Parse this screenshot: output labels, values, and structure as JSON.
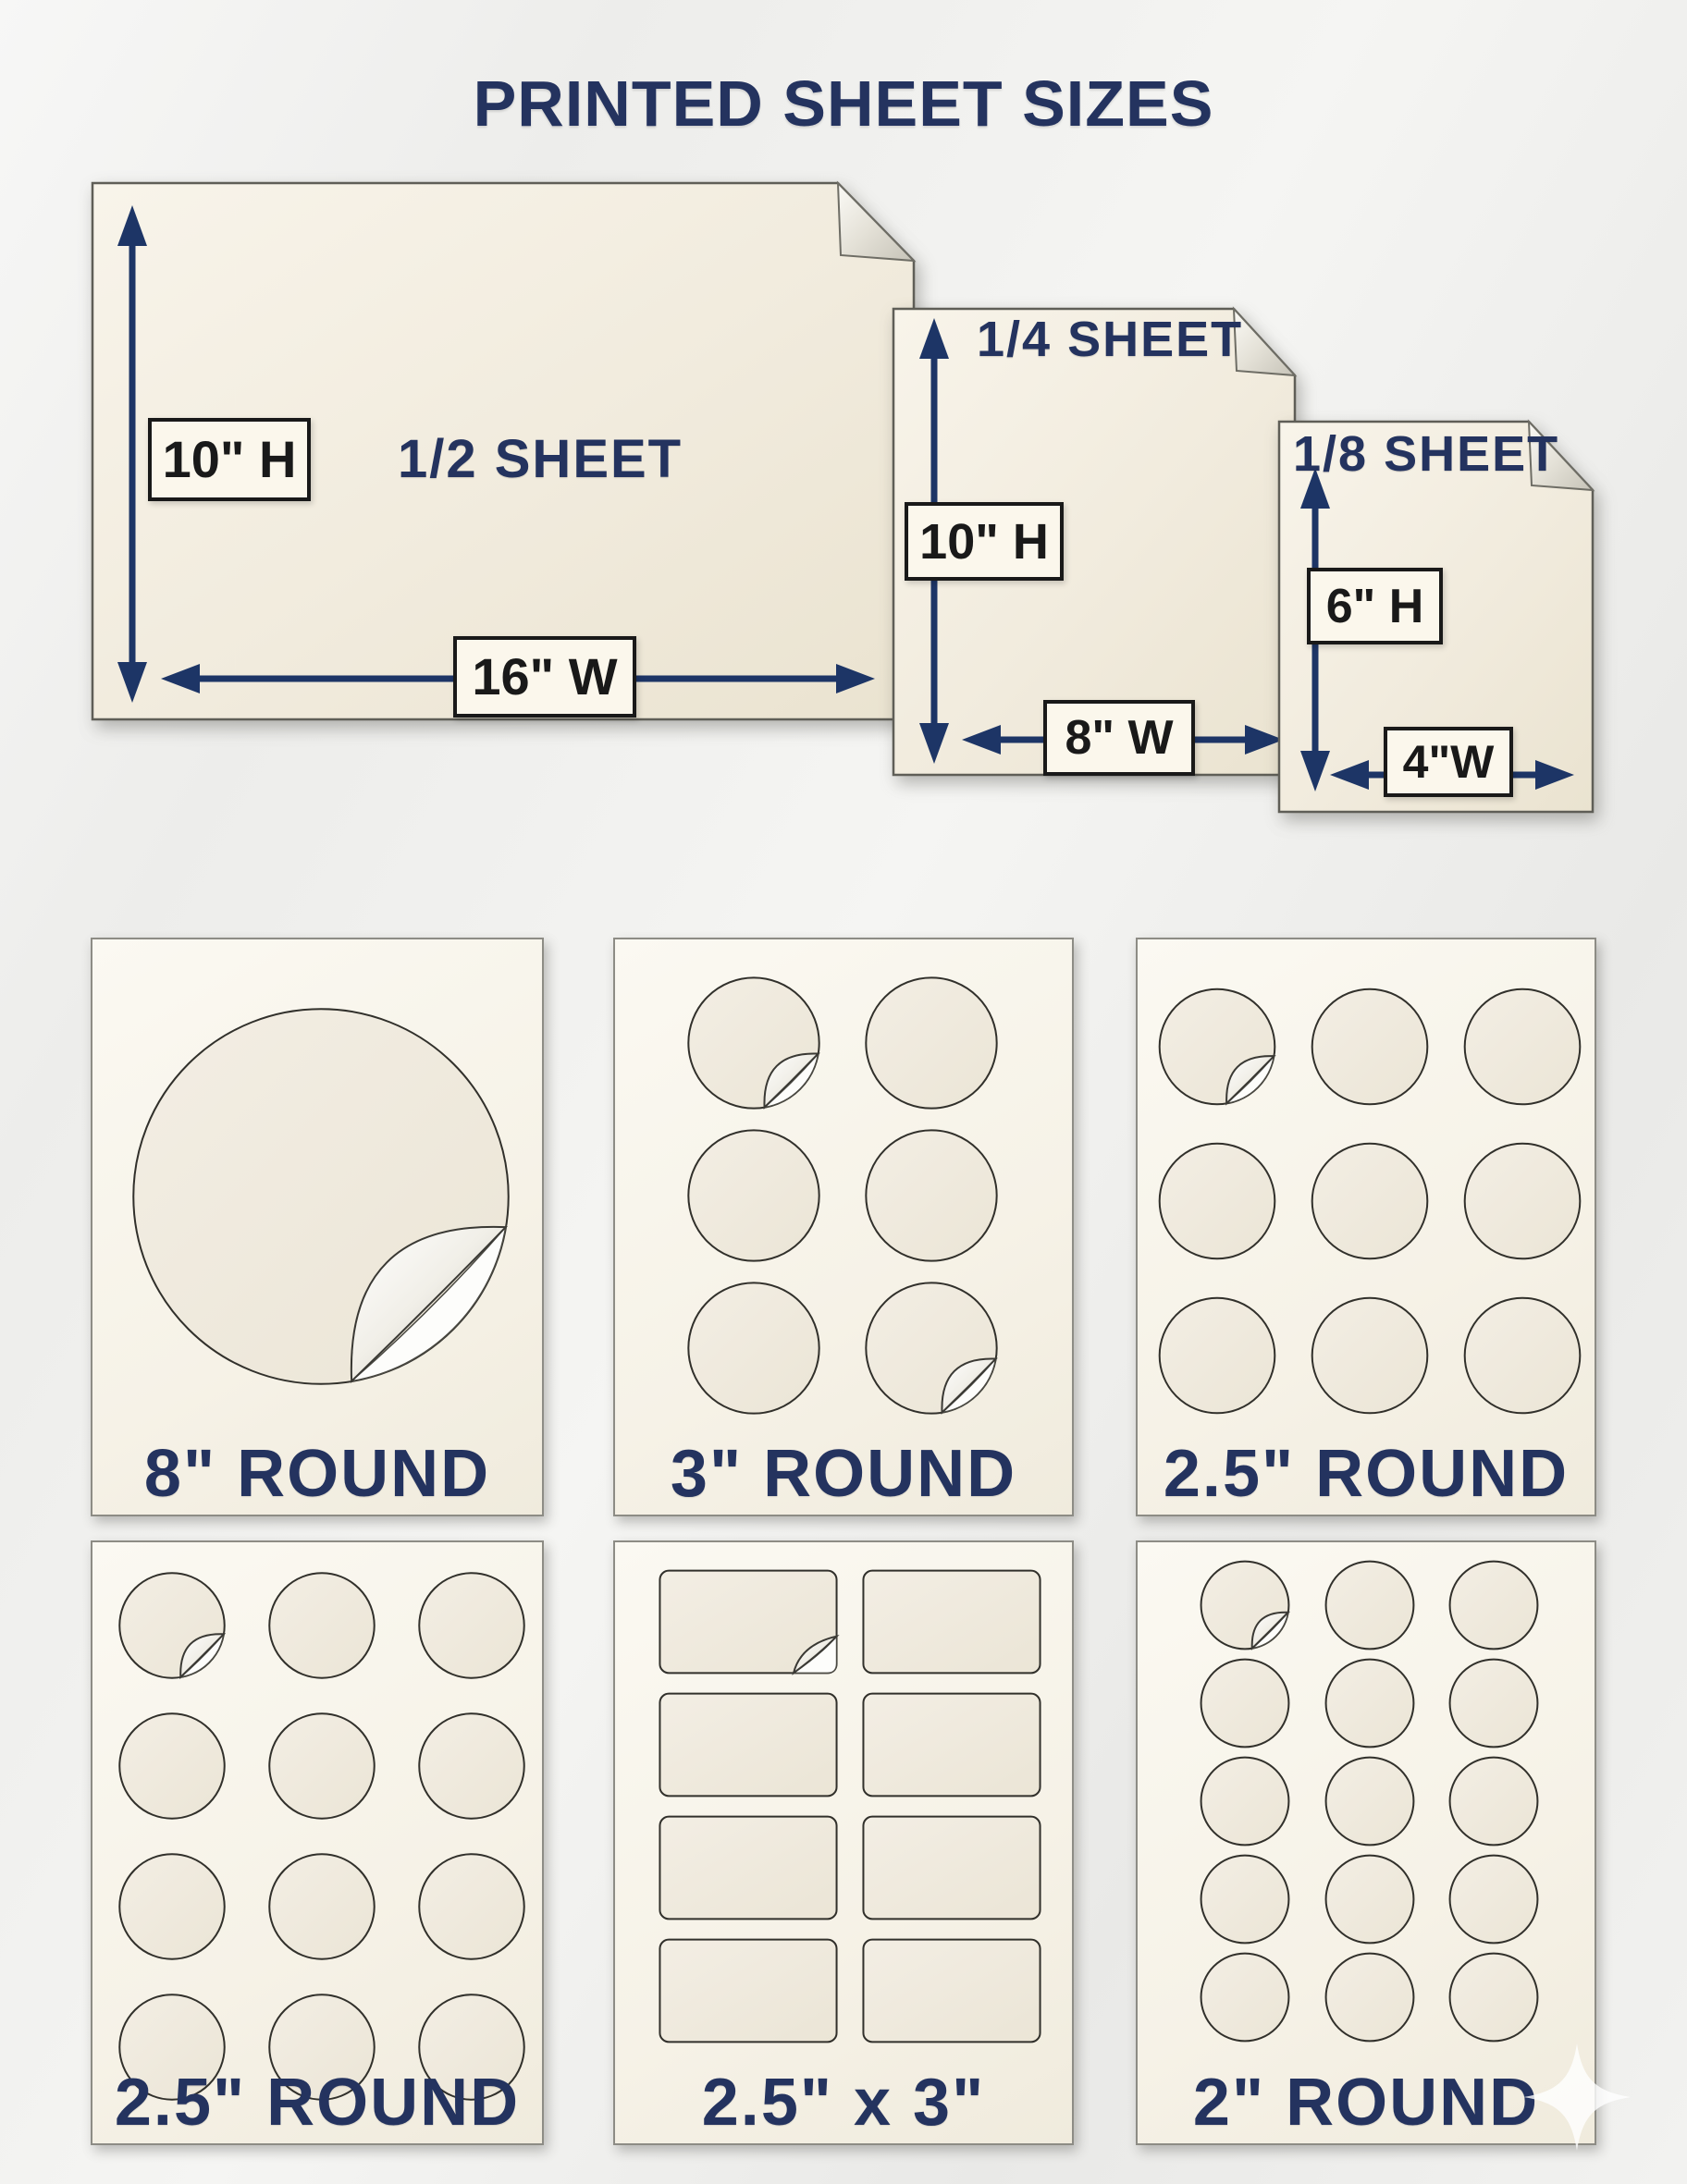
{
  "title": "PRINTED SHEET SIZES",
  "colors": {
    "navy": "#24335f",
    "label_navy": "#1f2e5e",
    "arrow": "#1d3566",
    "ink": "#191919",
    "sheet_fill": "#f4efe3",
    "card_fill": "#f8f5ec",
    "sheet_border": "#5f5e57"
  },
  "sheets": {
    "half": {
      "name": "1/2 SHEET",
      "height": "10\" H",
      "width": "16\" W"
    },
    "quarter": {
      "name": "1/4 SHEET",
      "height": "10\" H",
      "width": "8\" W"
    },
    "eighth": {
      "name": "1/8 SHEET",
      "height": "6\" H",
      "width": "4\"W"
    }
  },
  "cards": [
    {
      "label": "8\" ROUND",
      "shape": "circle",
      "rows": 1,
      "cols": 1,
      "count": 1,
      "peeled": [
        0
      ]
    },
    {
      "label": "3\" ROUND",
      "shape": "circle",
      "rows": 3,
      "cols": 2,
      "count": 6,
      "peeled": [
        0,
        5
      ]
    },
    {
      "label": "2.5\" ROUND",
      "shape": "circle",
      "rows": 3,
      "cols": 3,
      "count": 9,
      "peeled": [
        0
      ]
    },
    {
      "label": "2.5\" ROUND",
      "shape": "circle",
      "rows": 4,
      "cols": 3,
      "count": 12,
      "peeled": [
        0
      ]
    },
    {
      "label": "2.5\" x 3\"",
      "shape": "rect",
      "rows": 4,
      "cols": 2,
      "count": 8,
      "peeled": [
        0
      ]
    },
    {
      "label": "2\" ROUND",
      "shape": "circle",
      "rows": 5,
      "cols": 3,
      "count": 15,
      "peeled": [
        0
      ]
    }
  ]
}
